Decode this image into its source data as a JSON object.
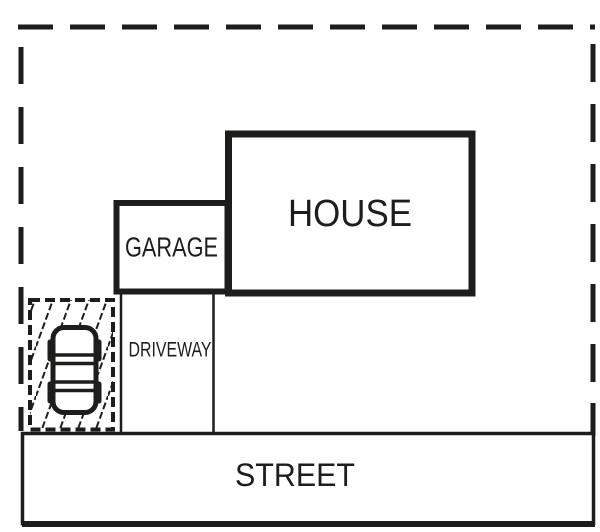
{
  "colors": {
    "line": "#1d1d1b",
    "background": "#ffffff"
  },
  "labels": {
    "house": "HOUSE",
    "garage": "GARAGE",
    "driveway": "DRIVEWAY",
    "street": "STREET"
  },
  "diagram": {
    "kind": "residential-site-plan",
    "visible_features": [
      "dashed property boundary line on top, left and right sides",
      "house footprint rectangle labeled HOUSE",
      "attached garage rectangle labeled GARAGE on left side of house",
      "driveway corridor labeled DRIVEWAY running from garage down to street",
      "street band labeled STREET across the bottom",
      "hatched parking pad with dashed border at lower left",
      "car shown in top view parked on the hatched pad"
    ]
  }
}
